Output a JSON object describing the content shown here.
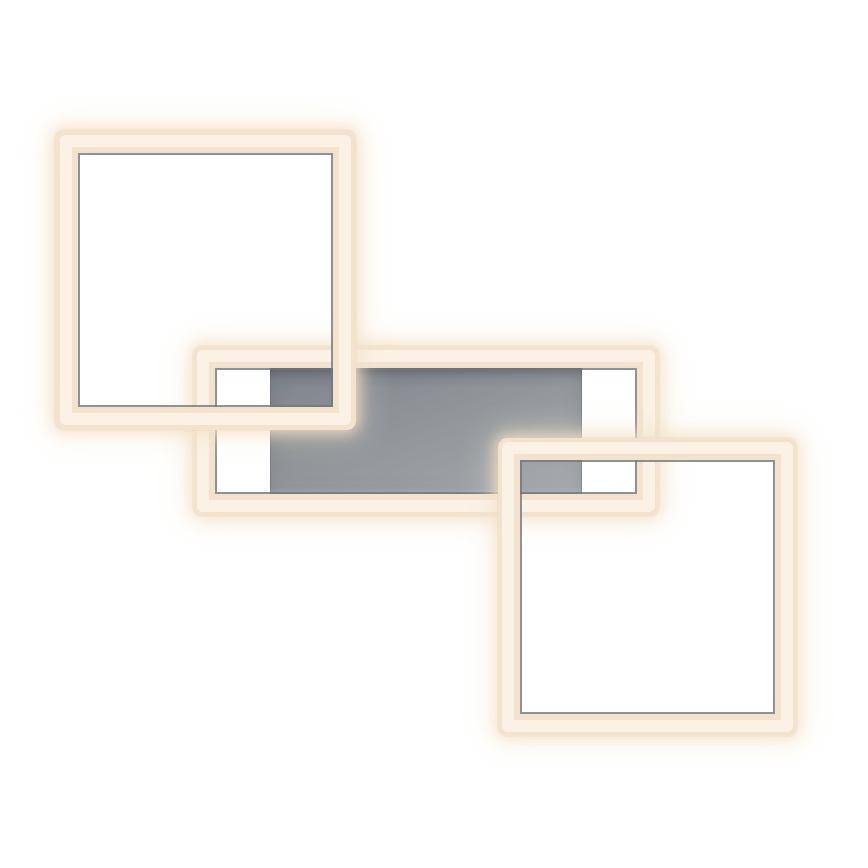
{
  "image": {
    "description": "Product photo of a modern LED ceiling light: three interlocking rectangular warm-white light frames (two squares and one wide rectangle) overlapping a grey brushed-metal canopy plate, on a plain white background",
    "background_color": "#ffffff"
  },
  "colors": {
    "bg": "#ffffff",
    "led-fill": "#f3e3cd",
    "led-highlight": "#fcf5e9",
    "led-glow": "rgba(243,224,197,0.85)",
    "led-glow-soft": "rgba(246,232,208,0.40)",
    "chrome-edge": "rgba(112,119,127,0.80)",
    "plate-dark": "#7e838a",
    "plate-mid": "#91959a",
    "plate-light": "#a9adb2"
  },
  "elements": {
    "canopy_plate": {
      "x": 270,
      "y": 368,
      "w": 312,
      "h": 126
    },
    "rect_middle": {
      "x": 193,
      "y": 346,
      "w": 466,
      "h": 170,
      "bar": 22
    },
    "square_top_left": {
      "x": 55,
      "y": 130,
      "w": 301,
      "h": 300,
      "bar": 23
    },
    "square_bottom_right": {
      "x": 498,
      "y": 438,
      "w": 299,
      "h": 298,
      "bar": 22
    }
  },
  "z_order": [
    "canopy_plate",
    "rect_middle",
    "square_top_left",
    "square_bottom_right"
  ]
}
